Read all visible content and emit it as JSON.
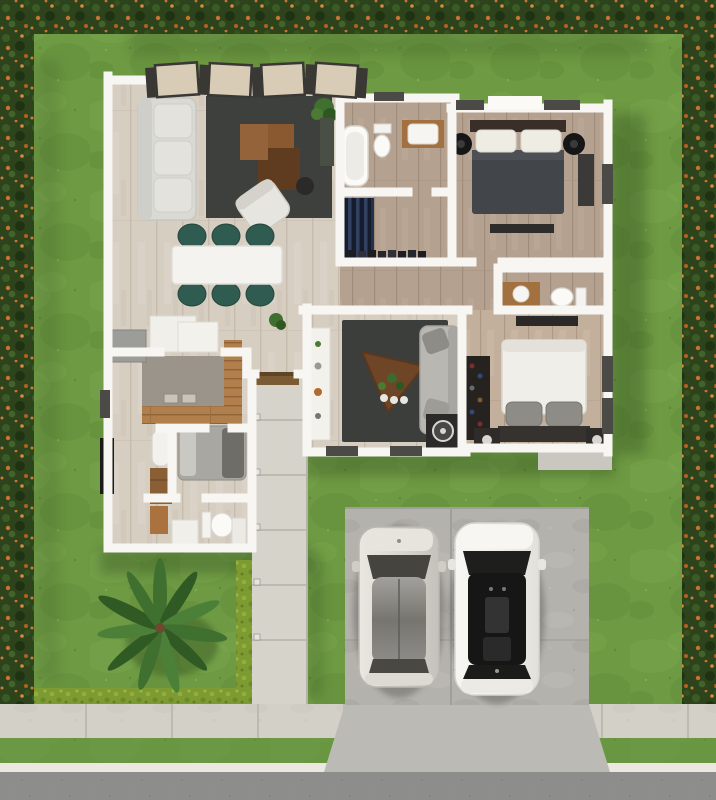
{
  "scene": {
    "title": "Top-view 3D rendering of a single-story house floor plan with lawn, flowering hedge border, front walkway, driveway and two parked cars",
    "rooms": [
      {
        "label": "living-room",
        "furniture": [
          "sectional-sofa",
          "area-rug",
          "wood-coffee-table",
          "lounge-chair",
          "side-table",
          "potted-plant",
          "sideboard"
        ]
      },
      {
        "label": "dining-area",
        "furniture": [
          "white-dining-table",
          "six-teal-chairs"
        ]
      },
      {
        "label": "kitchen",
        "furniture": [
          "l-shaped-wood-counter",
          "double-sink",
          "refrigerator",
          "white-cabinets"
        ]
      },
      {
        "label": "entry-hall",
        "furniture": [
          "doormat",
          "potted-plant"
        ]
      },
      {
        "label": "bathroom-top",
        "furniture": [
          "bathtub",
          "toilet",
          "wood-vanity"
        ]
      },
      {
        "label": "walk-in-closet",
        "furniture": [
          "hanging-clothes",
          "shoe-row"
        ]
      },
      {
        "label": "bedroom-1",
        "furniture": [
          "dark-double-bed",
          "white-pillows",
          "round-nightstands",
          "dresser",
          "foot-bench"
        ]
      },
      {
        "label": "hallway",
        "furniture": []
      },
      {
        "label": "bathroom-right",
        "furniture": [
          "toilet",
          "wood-vanity"
        ]
      },
      {
        "label": "bedroom-2",
        "furniture": [
          "white-double-bed",
          "gray-pillows",
          "wardrobe-shelf",
          "media-console",
          "nightstands"
        ]
      },
      {
        "label": "family-room",
        "furniture": [
          "area-rug",
          "triangular-coffee-table",
          "gray-sofa",
          "speaker",
          "white-console"
        ]
      },
      {
        "label": "utility-room",
        "furniture": [
          "water-heater",
          "wood-cabinet",
          "wall-tv"
        ]
      },
      {
        "label": "guest-room",
        "furniture": [
          "gray-daybed"
        ]
      },
      {
        "label": "bathroom-lower",
        "furniture": [
          "toilet",
          "vanity",
          "cabinet",
          "wood-shelf"
        ]
      }
    ],
    "exterior": [
      "lawn",
      "flowering-hedge-border",
      "low-yellow-hedge",
      "palm-tree",
      "front-walkway",
      "path-lights",
      "parking-pad",
      "driveway-apron",
      "sidewalk",
      "grass-verge",
      "curb",
      "road",
      "pergola-panels",
      "concrete-skirt"
    ],
    "vehicles": [
      {
        "label": "silver-suv",
        "position": "left-parking-spot"
      },
      {
        "label": "white-sedan",
        "position": "right-parking-spot"
      }
    ],
    "palette": {
      "grass": "#6E9A43",
      "grassLight": "#7FAE52",
      "grassDark": "#5D8836",
      "verge": "#659340",
      "hedge": "#2C431C",
      "hedgeMottleLight": "#3A5A26",
      "hedgeMottleDark": "#1F3313",
      "flower": "#C9732F",
      "flowerLight": "#D98A3F",
      "hedgeLow": "#7D9A33",
      "road": "#8D8D8B",
      "curb": "#EAE8E1",
      "sidewalk": "#D3D0C8",
      "walkway": "#D6D3CA",
      "drivePad": "#B4B2AC",
      "apron": "#BCBAB4",
      "wall": "#F7F6F2",
      "tileFloor": "#D7CEC2",
      "woodFloor": "#B5A190",
      "woodWarm": "#C2B09C",
      "deckWood": "#B07F4C",
      "counterGray": "#9B948A",
      "rug": "#3E403D",
      "sofa": "#DADAD5",
      "sofaGray": "#B9B7B1",
      "diningTable": "#F4F3EF",
      "chairTeal": "#2F5B50",
      "coffeeWood": "#8A5930",
      "coffeeWoodDark": "#5F3C20",
      "triTable": "#6E4526",
      "bedDark": "#42464A",
      "linen": "#EFECE4",
      "pillowGray": "#8E8C86",
      "headboard": "#3A2F28",
      "closetDark": "#262220",
      "clothesNavy": "#22304E",
      "appliance": "#9C9C98",
      "porcelain": "#FBFAF7",
      "vanityWood": "#A3703F",
      "windowFrame": "#4C4A46",
      "pergolaTan": "#D8CCB6",
      "pergolaBeam": "#3A3834",
      "carSilver": "#D9D7D0",
      "carWhite": "#F2F1ED",
      "glassDark": "#1E1E1D",
      "roofGlassGray": "#8A8884",
      "palm": "#3F7030",
      "palmDark": "#2F5A24",
      "palmLight": "#4C7F38",
      "trunk": "#6B4A2E",
      "shadow": "#233D14",
      "doormat": "#7A5B33",
      "speaker": "#2C2A28",
      "tv": "#1B1A19",
      "skirt": "#C9C7C0"
    }
  }
}
